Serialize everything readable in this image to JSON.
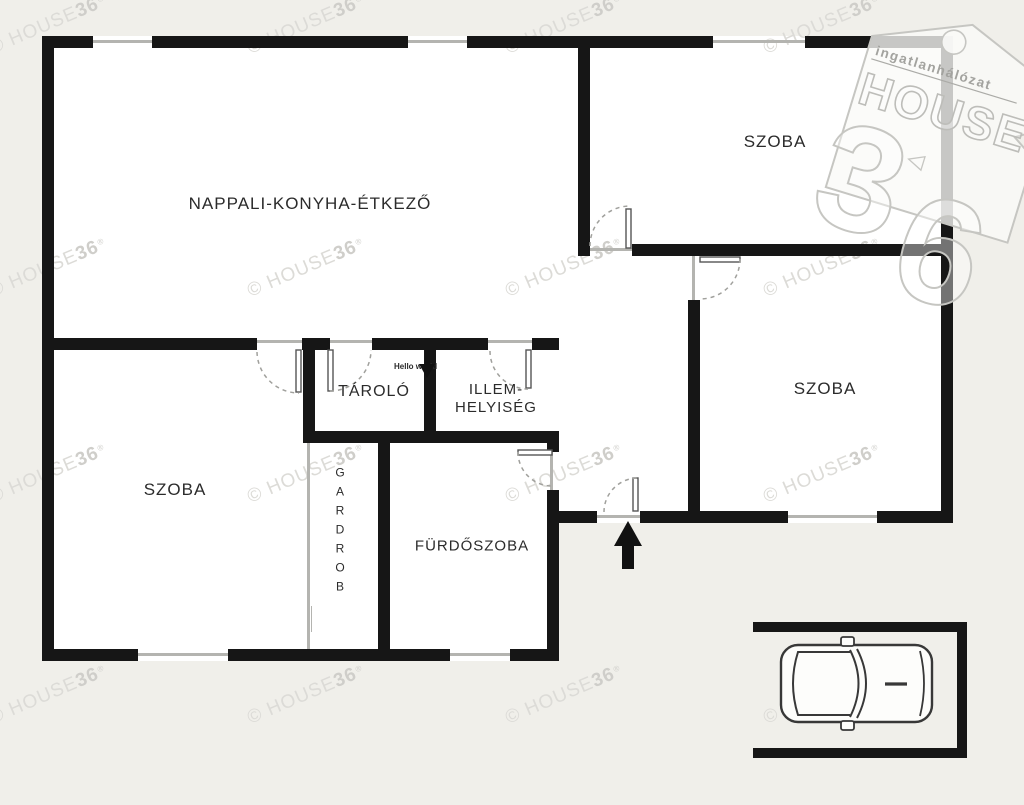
{
  "plan": {
    "rooms": {
      "nappali": "NAPPALI-KONYHA-ÉTKEZŐ",
      "szoba_top_right": "SZOBA",
      "szoba_right": "SZOBA",
      "szoba_bottom_left": "SZOBA",
      "tarolo": "TÁROLÓ",
      "illem_line1": "ILLEM-",
      "illem_line2": "HELYISÉG",
      "gardrob": "GARDROB",
      "furdoszoba": "FÜRDŐSZOBA"
    },
    "easter_egg_text": "Hello world"
  },
  "watermark": {
    "text_prefix": "© HOUSE",
    "text_bold": "36",
    "reg": "®",
    "positions": [
      [
        48,
        25
      ],
      [
        306,
        25
      ],
      [
        564,
        25
      ],
      [
        822,
        25
      ],
      [
        48,
        268
      ],
      [
        306,
        268
      ],
      [
        564,
        268
      ],
      [
        822,
        268
      ],
      [
        48,
        474
      ],
      [
        306,
        474
      ],
      [
        564,
        474
      ],
      [
        822,
        474
      ],
      [
        48,
        695
      ],
      [
        306,
        695
      ],
      [
        564,
        695
      ],
      [
        822,
        695
      ]
    ]
  },
  "logo": {
    "tagline": "ingatlanhálózat",
    "brand": "HOUSE",
    "number_3": "3",
    "number_6": "6"
  },
  "colors": {
    "background": "#f0efea",
    "wall": "#161616",
    "floor": "#ffffff",
    "window_line": "#b4b4b0",
    "watermark": "#dcdbd7",
    "label": "#2b2b2b"
  }
}
